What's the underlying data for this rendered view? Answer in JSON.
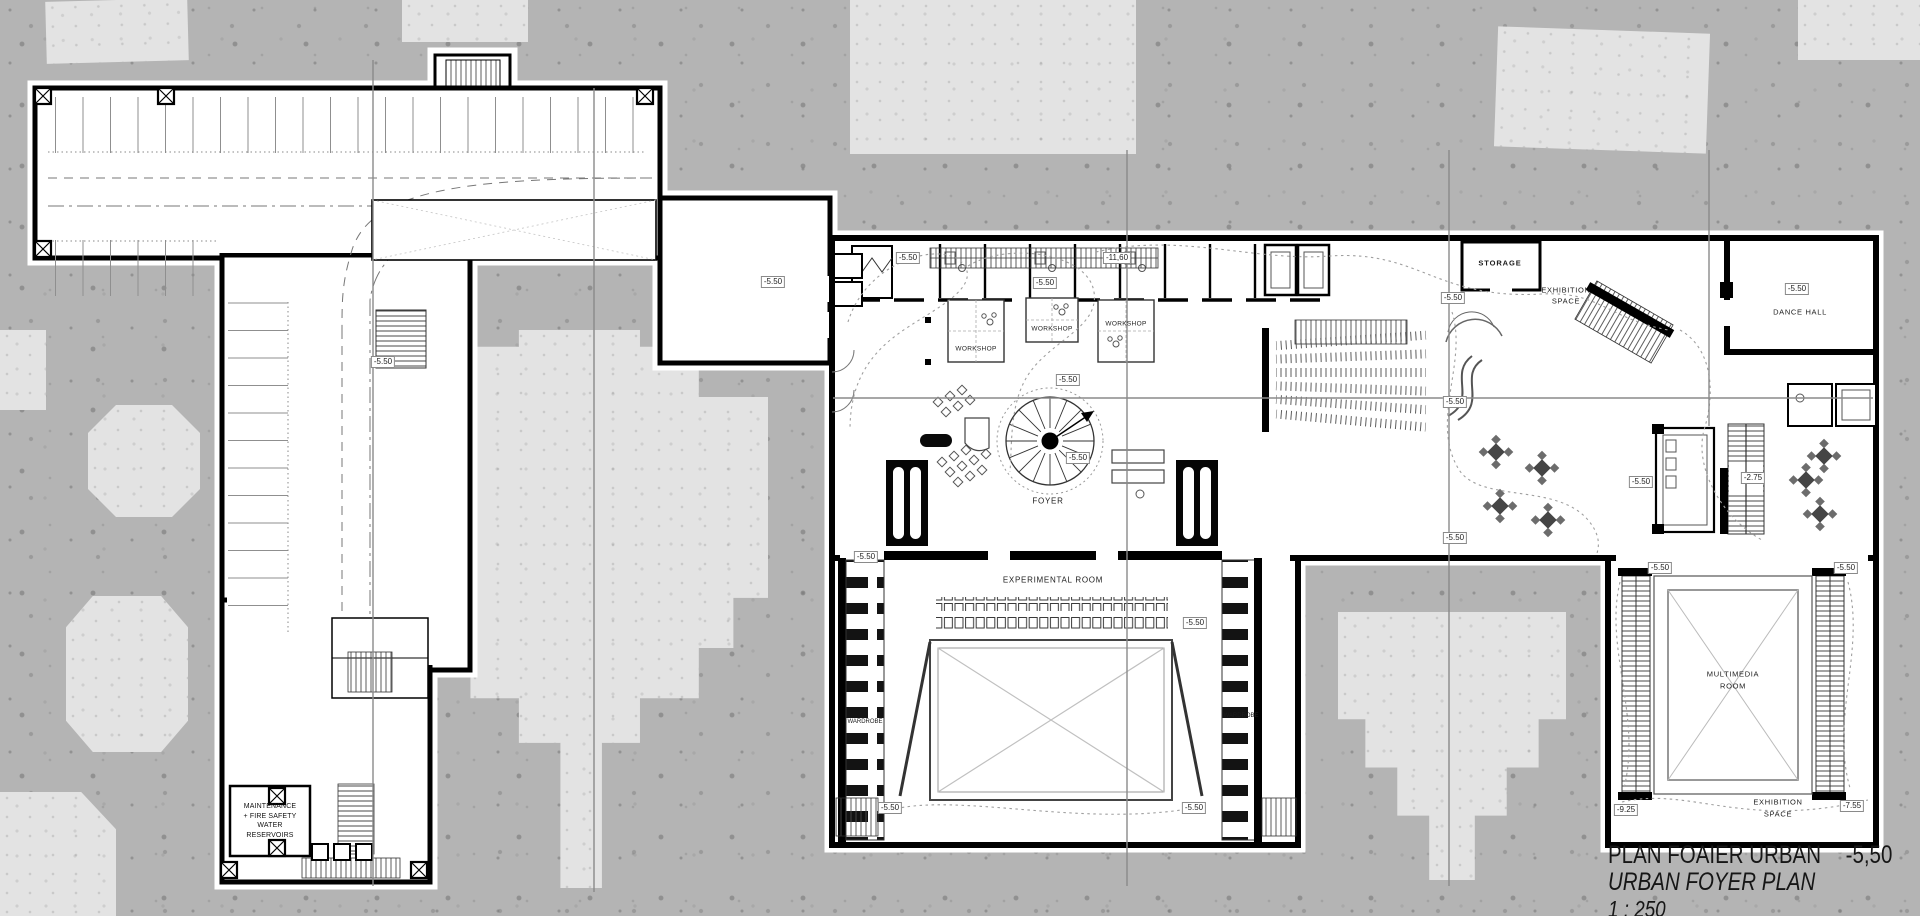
{
  "title_block": {
    "title_primary": "PLAN FOAIER URBAN",
    "level": "-5,50",
    "title_secondary": "URBAN FOYER PLAN",
    "scale": "1 : 250"
  },
  "levels": {
    "main": "-5.50",
    "deep": "-11,60",
    "mezzanine": "-2.75",
    "lower": "-9.25",
    "stage_level": "-7.55"
  },
  "rooms": {
    "storage": "STORAGE",
    "exhibition_upper_1": "EXHIBITION",
    "exhibition_upper_2": "SPACE",
    "dance_hall": "DANCE HALL",
    "workshop": "WORKSHOP",
    "foyer": "FOYER",
    "experimental": "EXPERIMENTAL ROOM",
    "wardrobe": "WARDROBE",
    "multimedia_1": "MULTIMEDIA",
    "multimedia_2": "ROOM",
    "exhibition_lower_1": "EXHIBITION",
    "exhibition_lower_2": "SPACE",
    "maintenance_1": "MAINTENANCE",
    "maintenance_2": "+ FIRE SAFETY",
    "maintenance_3": "WATER",
    "maintenance_4": "RESERVOIRS"
  }
}
